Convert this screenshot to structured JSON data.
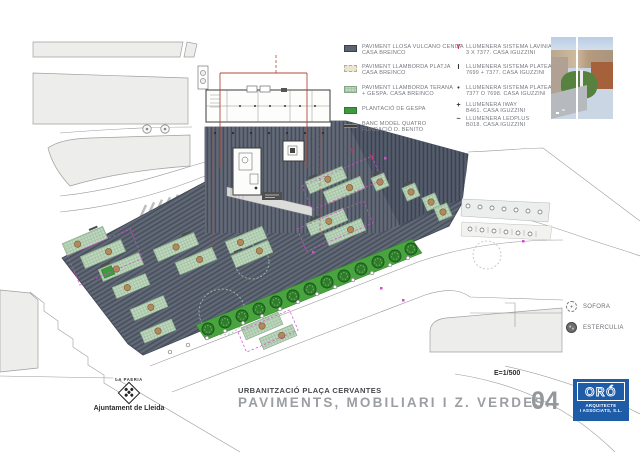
{
  "title_block": {
    "project": "URBANITZACIÓ PLAÇA CERVANTES",
    "sheet_title": "PAVIMENTS, MOBILIARI I Z. VERDES.",
    "sheet_number": "04",
    "scale": "E=1/500"
  },
  "legend_paving": [
    {
      "line1": "PAVIMENT LLOSA VULCANO CENIZA",
      "line2": "CASA BREINCO"
    },
    {
      "line1": "PAVIMENT LLAMBORDA PLATJA",
      "line2": "CASA BREINCO"
    },
    {
      "line1": "PAVIMENT LLAMBORDA TERANA",
      "line2": "+ GESPA. CASA BREINCO"
    },
    {
      "line1": "PLANTACIÓ DE GESPA",
      "line2": ""
    },
    {
      "line1": "BANC MODEL QUATRO",
      "line2": "FUNDACIÓ D. BENITO"
    }
  ],
  "legend_lighting": [
    {
      "symbol": "Y",
      "line1": "LLUMENERA SISTEMA LAVINIA",
      "line2": "3 X 7377. CASA IGUZZINI"
    },
    {
      "symbol": "I",
      "line1": "LLUMENERA SISTEMA PLATEA",
      "line2": "7699 + 7377. CASA IGUZZINI"
    },
    {
      "symbol": "•",
      "line1": "LLUMENERA SISTEMA PLATEA",
      "line2": "7377 O 7698. CASA IGUZZINI"
    },
    {
      "symbol": "+",
      "line1": "LLUMENERA IWAY",
      "line2": "B461. CASA IGUZZINI"
    },
    {
      "symbol": "~",
      "line1": "LLUMENERA LEDPLUS",
      "line2": "B018. CASA IGUZZINI"
    }
  ],
  "legend_trees": [
    {
      "label": "SOFORA"
    },
    {
      "label": "ESTERCULIA"
    }
  ],
  "logos": {
    "lleida_top": "LA PAERIA",
    "lleida_name": "Ajuntament de Lleida",
    "oro_name": "ORÓ",
    "oro_sub1": "ARQUITECTE",
    "oro_sub2": "I ASSOCIATS, S.L."
  },
  "colors": {
    "plaza_paving": "#5c6371",
    "grass_strip": "#49a33e",
    "patch_green": "#c0d8c0",
    "beige_paving": "#eae4d2",
    "boundary_red": "#b04a3a",
    "annotation_magenta": "#cf4fcf",
    "oro_blue": "#1f5ca8"
  }
}
